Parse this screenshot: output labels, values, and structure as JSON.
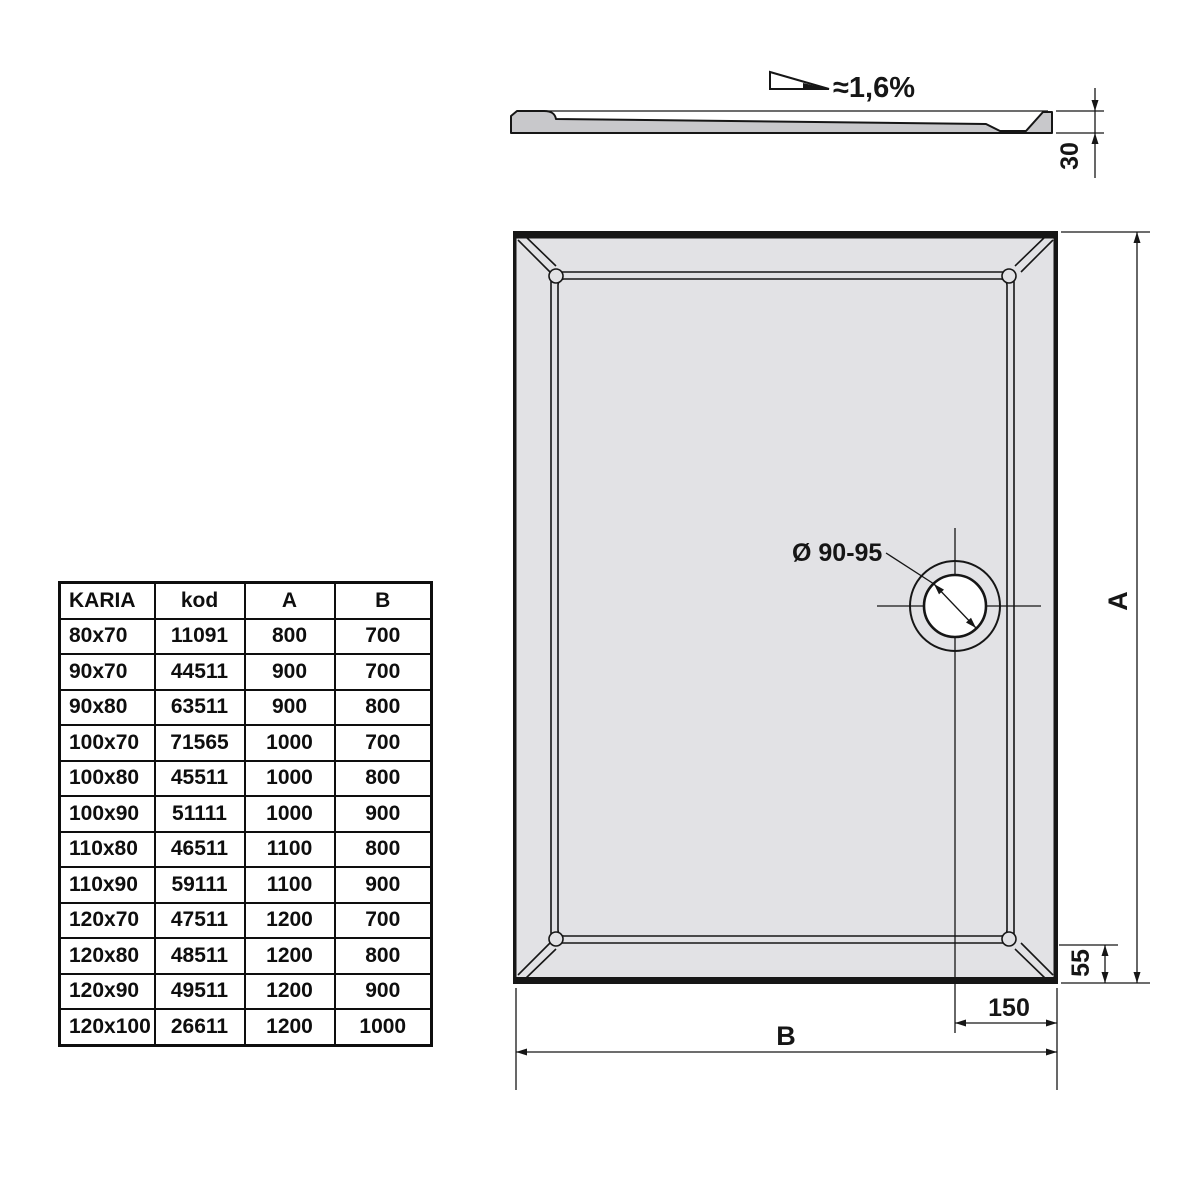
{
  "section_view": {
    "slope_label": "≈1,6%",
    "height_dim": "30"
  },
  "plan_view": {
    "drain_label": "Ø 90-95",
    "dim_a_label": "A",
    "dim_b_label": "B",
    "dim_drain_offset": "150",
    "dim_rim_width": "55"
  },
  "table": {
    "headers": [
      "KARIA",
      "kod",
      "A",
      "B"
    ],
    "rows": [
      [
        "80x70",
        "11091",
        "800",
        "700"
      ],
      [
        "90x70",
        "44511",
        "900",
        "700"
      ],
      [
        "90x80",
        "63511",
        "900",
        "800"
      ],
      [
        "100x70",
        "71565",
        "1000",
        "700"
      ],
      [
        "100x80",
        "45511",
        "1000",
        "800"
      ],
      [
        "100x90",
        "51111",
        "1000",
        "900"
      ],
      [
        "110x80",
        "46511",
        "1100",
        "800"
      ],
      [
        "110x90",
        "59111",
        "1100",
        "900"
      ],
      [
        "120x70",
        "47511",
        "1200",
        "700"
      ],
      [
        "120x80",
        "48511",
        "1200",
        "800"
      ],
      [
        "120x90",
        "49511",
        "1200",
        "900"
      ],
      [
        "120x100",
        "26611",
        "1200",
        "1000"
      ]
    ]
  },
  "colors": {
    "line": "#161616",
    "plan_fill": "#e2e2e5",
    "section_fill": "#c8c8cb"
  }
}
